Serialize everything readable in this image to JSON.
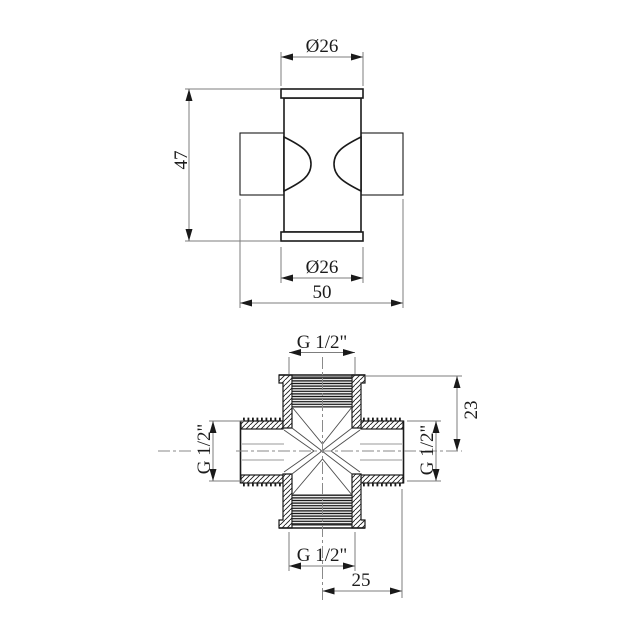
{
  "drawing_title": "cross-fitting-technical-drawing",
  "colors": {
    "background": "#ffffff",
    "outline": "#1a1a1a",
    "dimension_lines": "#7d7d7d",
    "text": "#1c1c1c"
  },
  "front_view": {
    "dim_top_diameter": "Ø26",
    "dim_height": "47",
    "dim_bottom_diameter": "Ø26",
    "dim_overall_width": "50"
  },
  "section_view": {
    "dim_top_thread": "G 1/2\"",
    "dim_left_thread": "G 1/2\"",
    "dim_right_thread": "G 1/2\"",
    "dim_bottom_thread": "G 1/2\"",
    "dim_height_23": "23",
    "dim_width_25": "25"
  }
}
